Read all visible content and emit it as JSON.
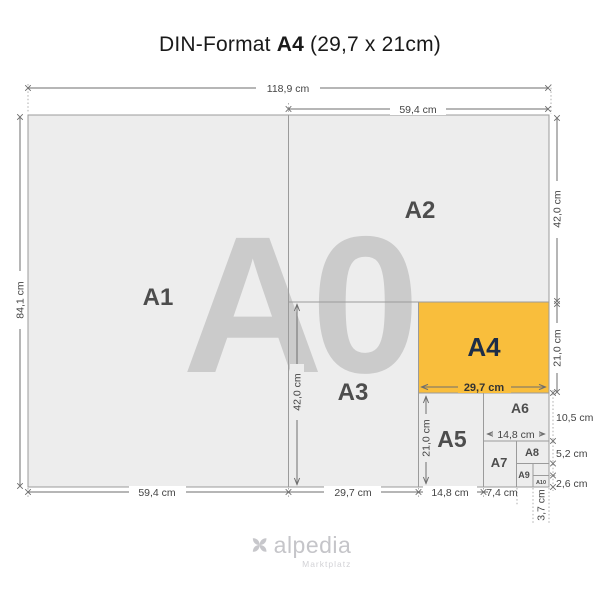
{
  "title": {
    "prefix": "DIN-Format ",
    "format": "A4",
    "suffix": " (29,7 x 21cm)"
  },
  "watermark": "A0",
  "papers": {
    "a1": "A1",
    "a2": "A2",
    "a3": "A3",
    "a4": "A4",
    "a5": "A5",
    "a6": "A6",
    "a7": "A7",
    "a8": "A8",
    "a9": "A9",
    "a10": "A10"
  },
  "dims": {
    "w_a0": "118,9 cm",
    "h_a0": "84,1 cm",
    "w_a1": "59,4 cm",
    "h_a2": "42,0 cm",
    "w_a4": "29,7 cm",
    "h_a4": "21,0 cm",
    "w_a6": "14,8 cm",
    "h_a6": "10,5 cm",
    "w_a7": "7,4 cm",
    "h_a8": "5,2 cm",
    "w_a10": "3,7 cm",
    "h_a10": "2,6 cm"
  },
  "colors": {
    "accent": "#F9BE3C",
    "paper": "#EDEDED",
    "border": "#9B9B9B",
    "navy": "#1D2D47",
    "watermark": "#CBCBCB",
    "dim_text": "#444444"
  },
  "logo": {
    "name": "alpedia",
    "tagline": "Marktplatz"
  }
}
